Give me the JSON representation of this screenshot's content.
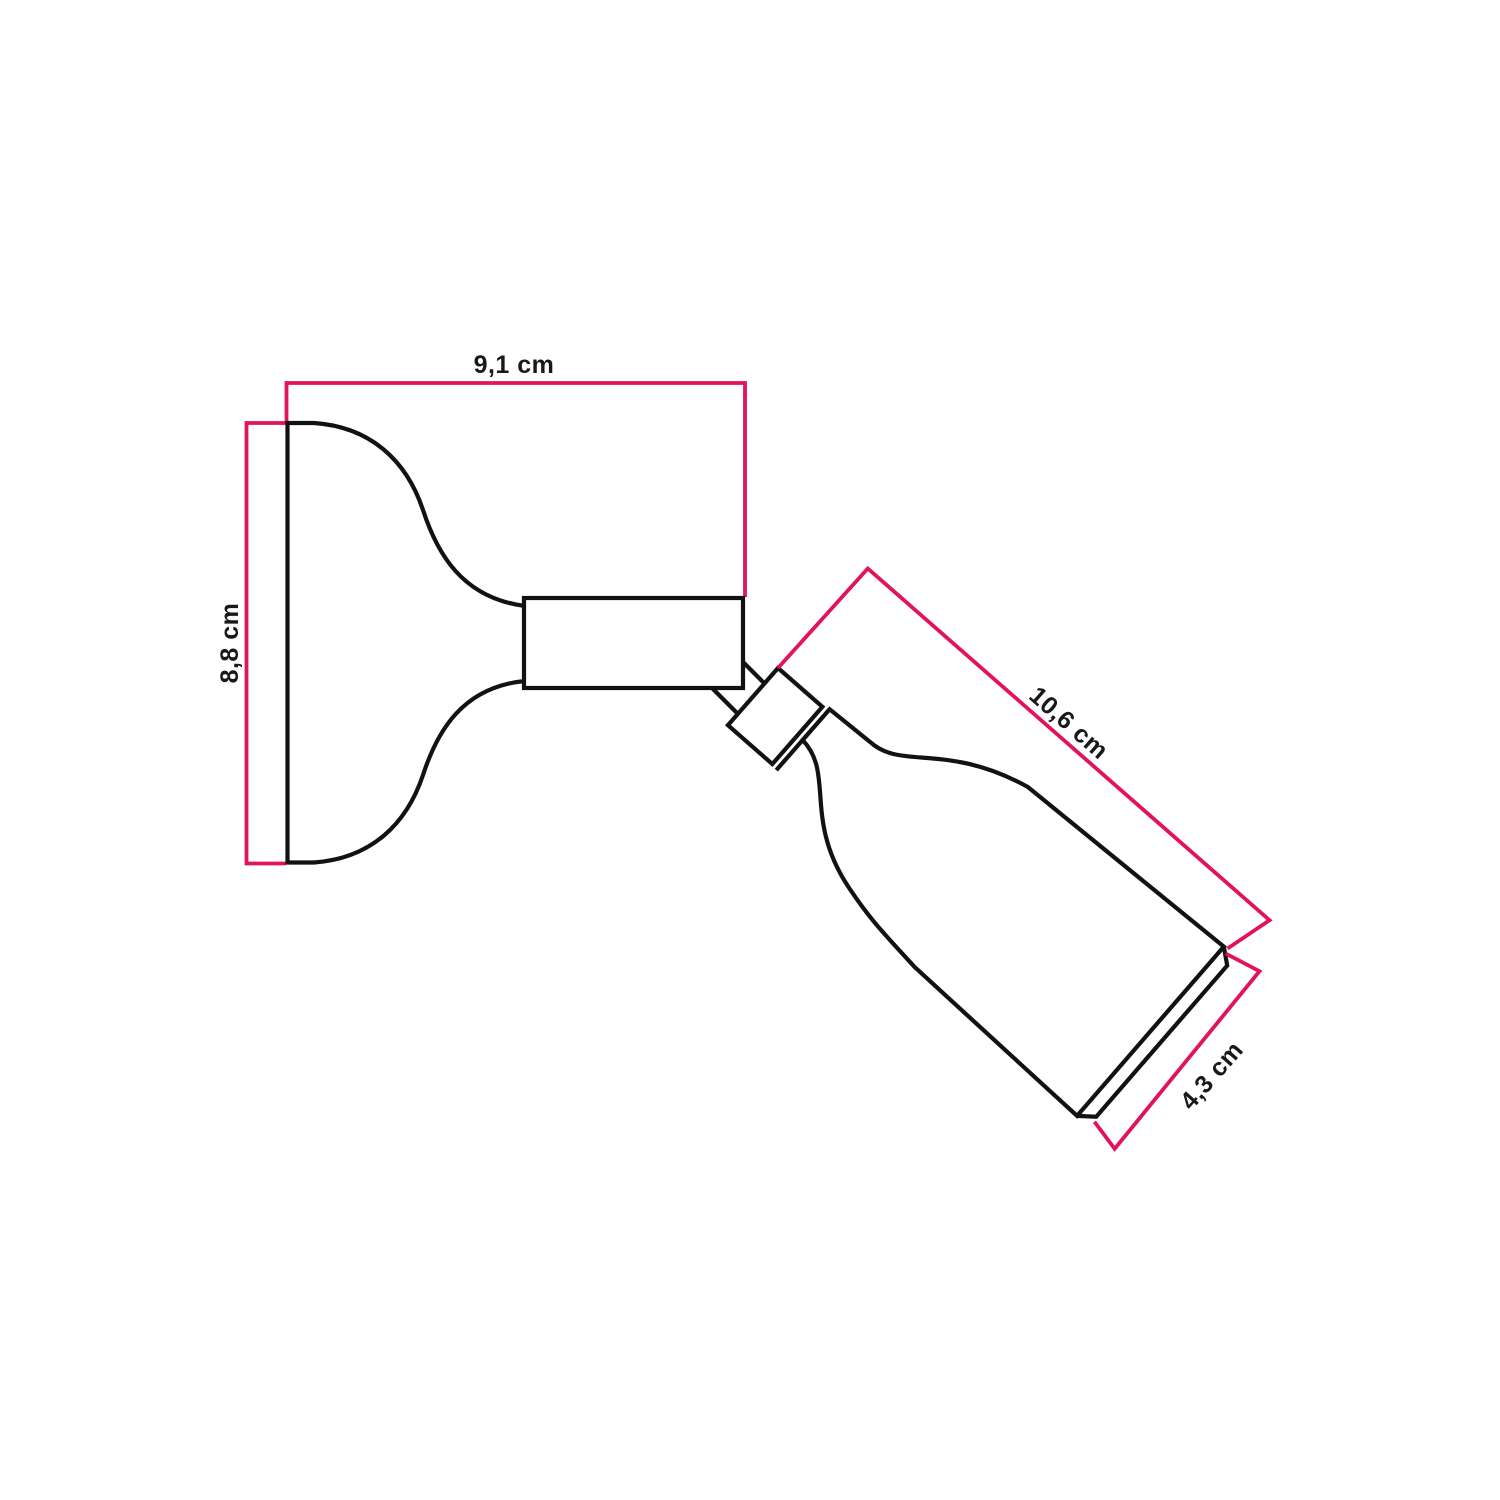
{
  "page": {
    "background_color": "#ffffff"
  },
  "colors": {
    "dimension_line": "#e2125e",
    "drawing_line": "#121212",
    "label_text": "#191919"
  },
  "dimensions": {
    "plate_width": {
      "label": "9,1 cm",
      "value": "9,1",
      "unit": "cm"
    },
    "plate_height": {
      "label": "8,8 cm",
      "value": "8,8",
      "unit": "cm"
    },
    "holder_length": {
      "label": "10,6 cm",
      "value": "10,6",
      "unit": "cm"
    },
    "holder_diameter": {
      "label": "4,3 cm",
      "value": "4,3",
      "unit": "cm"
    }
  }
}
